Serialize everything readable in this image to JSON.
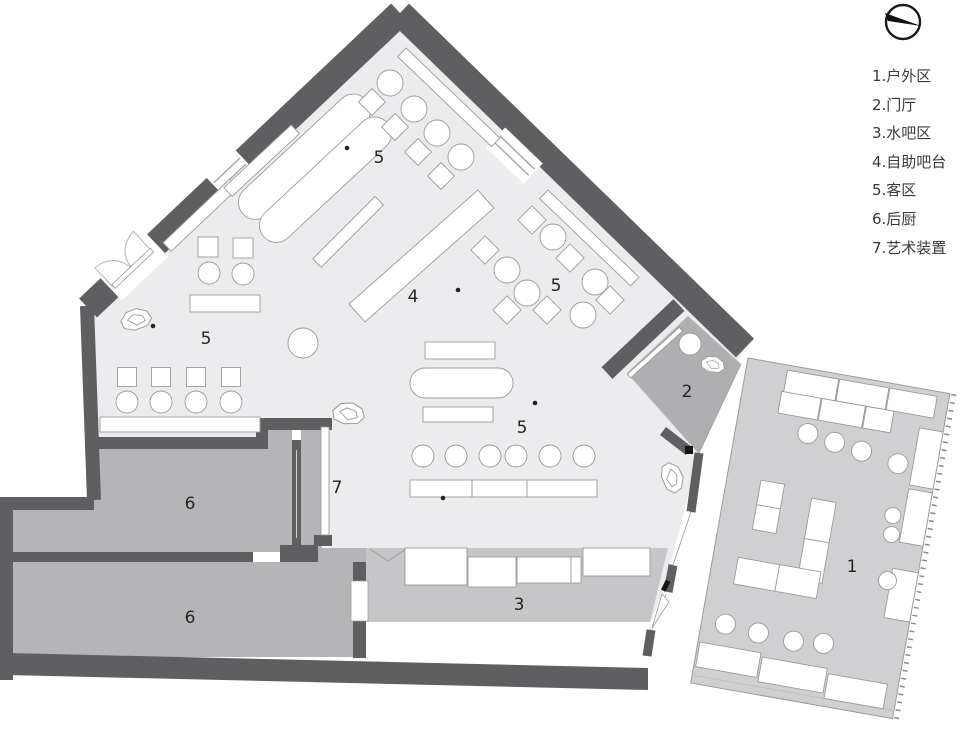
{
  "colors": {
    "wall": "#5f5f62",
    "floor-hall": "#ececee",
    "floor-entrance": "#afafb2",
    "floor-kitchen": "#b5b5b7",
    "floor-waterbar": "#c6c6c8",
    "floor-outdoor": "#d0d0d2",
    "furniture-stroke": "#9b9b9b",
    "label": "#242424",
    "legend-text": "#3a3a3a",
    "compass": "#1a1a1a"
  },
  "legend": {
    "items": [
      {
        "text": "1.户外区"
      },
      {
        "text": "2.门厅"
      },
      {
        "text": "3.水吧区"
      },
      {
        "text": "4.自助吧台"
      },
      {
        "text": "5.客区"
      },
      {
        "text": "6.后厨"
      },
      {
        "text": "7.艺术装置"
      }
    ]
  },
  "zones": {
    "outdoor": {
      "number": "1"
    },
    "entrance": {
      "number": "2"
    },
    "water_bar": {
      "number": "3"
    },
    "buffet_bar": {
      "number": "4"
    },
    "guest_top": {
      "number": "5"
    },
    "guest_left": {
      "number": "5"
    },
    "guest_right": {
      "number": "5"
    },
    "guest_center": {
      "number": "5"
    },
    "kitchen_upper": {
      "number": "6"
    },
    "kitchen_lower": {
      "number": "6"
    },
    "art_installation": {
      "number": "7"
    }
  }
}
